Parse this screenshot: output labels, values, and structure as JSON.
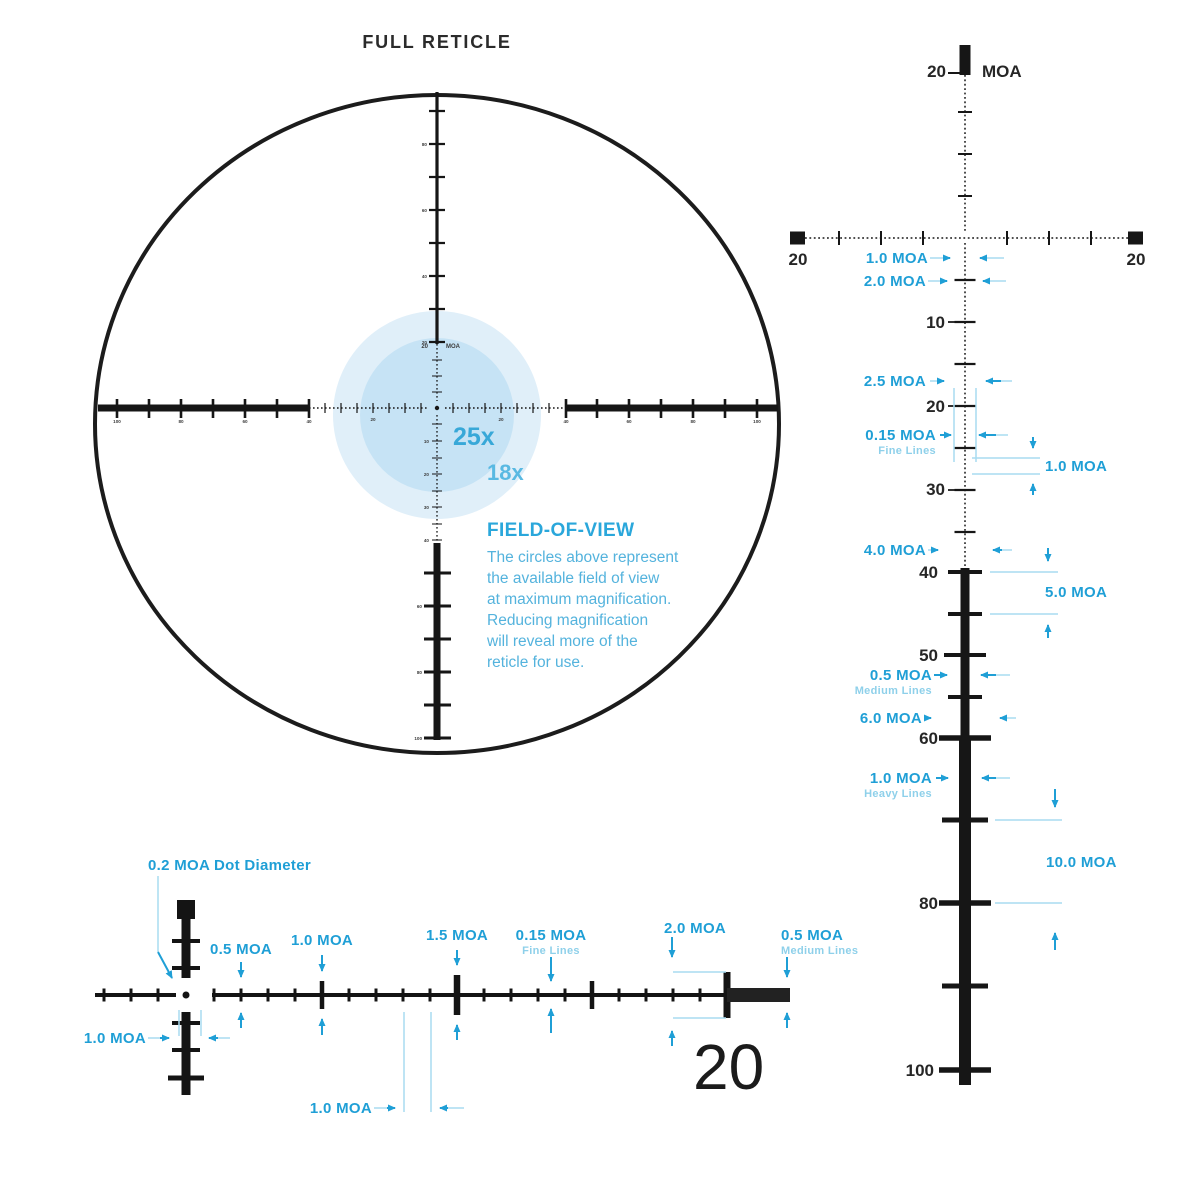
{
  "full_reticle": {
    "title": "FULL RETICLE",
    "center_tick_value": "20",
    "center_tick_unit": "MOA",
    "fov": {
      "mag_inner": "25x",
      "mag_outer": "18x",
      "heading": "FIELD-OF-VIEW",
      "lines": [
        "The circles above represent",
        "the available field of view",
        "at maximum magnification.",
        "Reducing magnification",
        "will reveal more of the",
        "reticle for use."
      ]
    },
    "micro": {
      "left": [
        "100",
        "80",
        "60",
        "40",
        "20"
      ],
      "right": [
        "20",
        "40",
        "60",
        "80",
        "100"
      ],
      "top": [
        "80",
        "60",
        "40",
        "20"
      ],
      "bottom": [
        "10",
        "20",
        "30",
        "40",
        "60",
        "80",
        "100"
      ]
    }
  },
  "vertical_detail": {
    "top_value": "20",
    "unit": "MOA",
    "h_end_left": "20",
    "h_end_right": "20",
    "scale": [
      "10",
      "20",
      "30",
      "40",
      "50",
      "60",
      "80",
      "100"
    ],
    "ann": [
      {
        "t": "1.0 MOA"
      },
      {
        "t": "2.0 MOA"
      },
      {
        "t": "2.5 MOA"
      },
      {
        "t": "0.15 MOA",
        "s": "Fine Lines"
      },
      {
        "t": "1.0 MOA"
      },
      {
        "t": "4.0 MOA"
      },
      {
        "t": "5.0 MOA"
      },
      {
        "t": "0.5 MOA",
        "s": "Medium Lines"
      },
      {
        "t": "6.0 MOA"
      },
      {
        "t": "1.0 MOA",
        "s": "Heavy Lines"
      },
      {
        "t": "10.0 MOA"
      }
    ]
  },
  "horizontal_detail": {
    "end_value": "20",
    "ann": [
      {
        "t": "0.2 MOA Dot Diameter"
      },
      {
        "t": "1.0 MOA"
      },
      {
        "t": "0.5 MOA"
      },
      {
        "t": "1.0 MOA"
      },
      {
        "t": "1.5 MOA"
      },
      {
        "t": "0.15 MOA",
        "s": "Fine Lines"
      },
      {
        "t": "2.0 MOA"
      },
      {
        "t": "0.5 MOA",
        "s": "Medium Lines"
      },
      {
        "t": "1.0 MOA"
      }
    ]
  },
  "colors": {
    "ink": "#1b1b1b",
    "annotation_cyan": "#1f9fd6",
    "leader_light": "#a9dcf0",
    "fov_outer": "#e0eff9",
    "fov_inner": "#c6e3f5"
  }
}
